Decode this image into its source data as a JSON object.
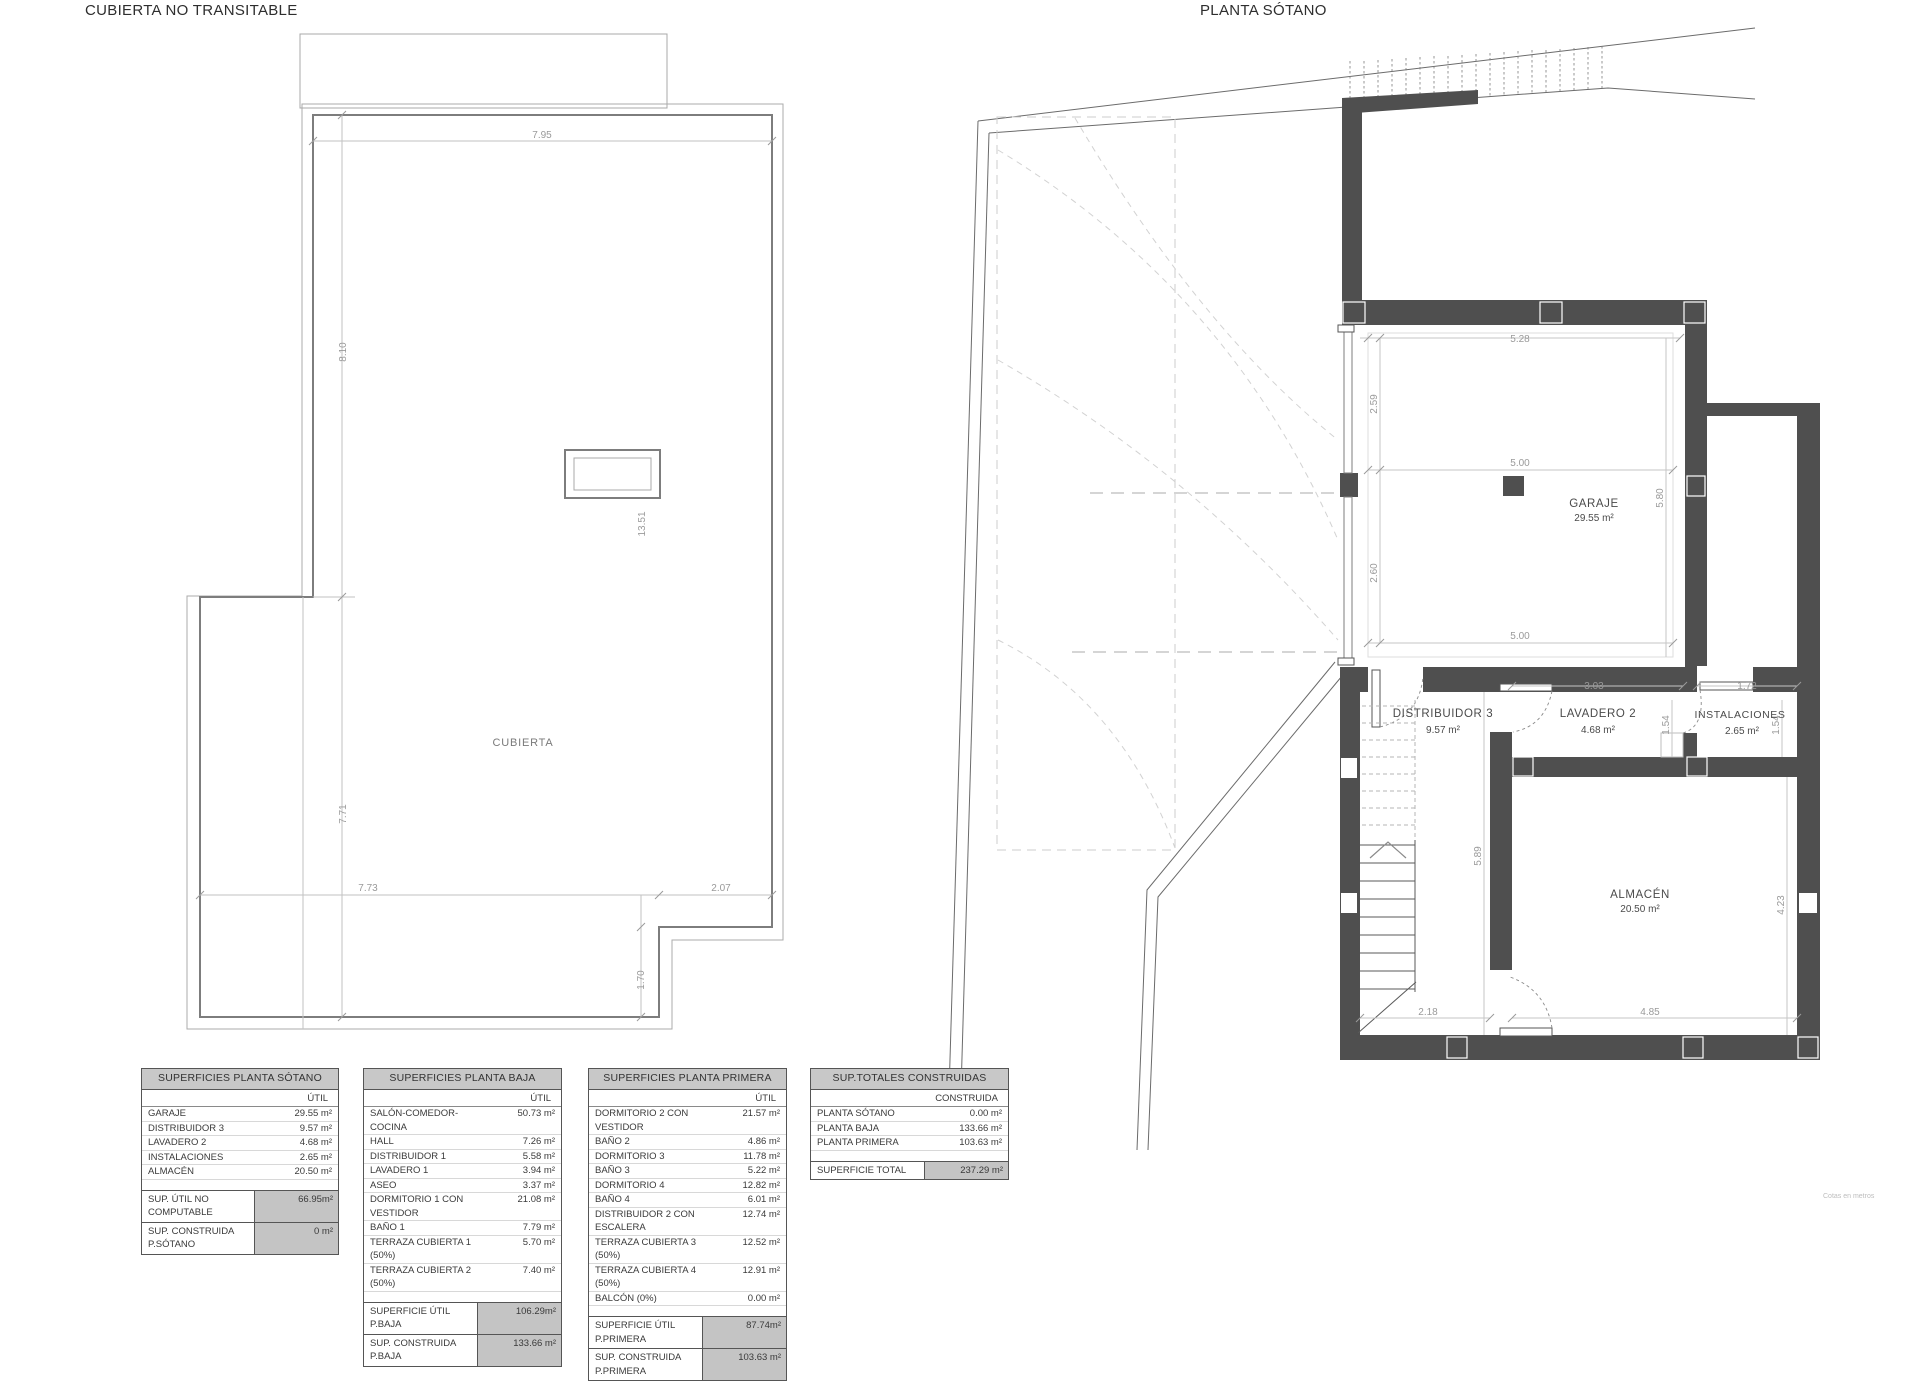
{
  "left_plan": {
    "title": "CUBIERTA NO TRANSITABLE",
    "room_label": "CUBIERTA",
    "dims": {
      "top": "7.95",
      "left_upper": "8.10",
      "left_lower": "7.71",
      "skylight": "13.51",
      "bottom_left": "7.73",
      "bottom_right": "2.07",
      "notch": "1.70"
    }
  },
  "right_plan": {
    "title": "PLANTA SÓTANO",
    "rooms": {
      "garaje": {
        "name": "GARAJE",
        "area": "29.55 m²"
      },
      "distribuidor": {
        "name": "DISTRIBUIDOR 3",
        "area": "9.57 m²"
      },
      "lavadero": {
        "name": "LAVADERO 2",
        "area": "4.68 m²"
      },
      "instalaciones": {
        "name": "INSTALACIONES",
        "area": "2.65 m²"
      },
      "almacen": {
        "name": "ALMACÉN",
        "area": "20.50 m²"
      }
    },
    "dims": {
      "d528": "5.28",
      "d259": "2.59",
      "d500a": "5.00",
      "d580": "5.80",
      "d260": "2.60",
      "d500b": "5.00",
      "d303": "3.03",
      "d172": "1.72",
      "d154a": "1.54",
      "d154b": "1.54",
      "d589": "5.89",
      "d218": "2.18",
      "d485": "4.85",
      "d423": "4.23"
    }
  },
  "tables": [
    {
      "title": "SUPERFICIES PLANTA SÓTANO",
      "col": "ÚTIL",
      "rows": [
        [
          "GARAJE",
          "29.55 m²"
        ],
        [
          "DISTRIBUIDOR 3",
          "9.57 m²"
        ],
        [
          "LAVADERO 2",
          "4.68 m²"
        ],
        [
          "INSTALACIONES",
          "2.65 m²"
        ],
        [
          "ALMACÉN",
          "20.50 m²"
        ]
      ],
      "summary": [
        [
          "SUP. ÚTIL NO COMPUTABLE",
          "66.95m²"
        ],
        [
          "SUP. CONSTRUIDA P.SÓTANO",
          "0 m²"
        ]
      ]
    },
    {
      "title": "SUPERFICIES PLANTA BAJA",
      "col": "ÚTIL",
      "rows": [
        [
          "SALÓN-COMEDOR-COCINA",
          "50.73 m²"
        ],
        [
          "HALL",
          "7.26 m²"
        ],
        [
          "DISTRIBUIDOR 1",
          "5.58 m²"
        ],
        [
          "LAVADERO 1",
          "3.94 m²"
        ],
        [
          "ASEO",
          "3.37 m²"
        ],
        [
          "DORMITORIO 1 CON VESTIDOR",
          "21.08 m²"
        ],
        [
          "BAÑO 1",
          "7.79 m²"
        ],
        [
          "TERRAZA CUBIERTA 1 (50%)",
          "5.70 m²"
        ],
        [
          "TERRAZA CUBIERTA 2 (50%)",
          "7.40 m²"
        ]
      ],
      "summary": [
        [
          "SUPERFICIE ÚTIL P.BAJA",
          "106.29m²"
        ],
        [
          "SUP. CONSTRUIDA P.BAJA",
          "133.66 m²"
        ]
      ]
    },
    {
      "title": "SUPERFICIES PLANTA PRIMERA",
      "col": "ÚTIL",
      "rows": [
        [
          "DORMITORIO 2 CON VESTIDOR",
          "21.57 m²"
        ],
        [
          "BAÑO 2",
          "4.86 m²"
        ],
        [
          "DORMITORIO 3",
          "11.78 m²"
        ],
        [
          "BAÑO 3",
          "5.22 m²"
        ],
        [
          "DORMITORIO 4",
          "12.82 m²"
        ],
        [
          "BAÑO 4",
          "6.01 m²"
        ],
        [
          "DISTRIBUIDOR 2 CON ESCALERA",
          "12.74 m²"
        ],
        [
          "TERRAZA CUBIERTA 3 (50%)",
          "12.52 m²"
        ],
        [
          "TERRAZA CUBIERTA 4 (50%)",
          "12.91 m²"
        ],
        [
          "BALCÓN (0%)",
          "0.00 m²"
        ]
      ],
      "summary": [
        [
          "SUPERFICIE ÚTIL P.PRIMERA",
          "87.74m²"
        ],
        [
          "SUP. CONSTRUIDA P.PRIMERA",
          "103.63 m²"
        ]
      ]
    },
    {
      "title": "SUP.TOTALES CONSTRUIDAS",
      "col": "CONSTRUIDA",
      "rows": [
        [
          "PLANTA SÓTANO",
          "0.00 m²"
        ],
        [
          "PLANTA BAJA",
          "133.66 m²"
        ],
        [
          "PLANTA PRIMERA",
          "103.63 m²"
        ]
      ],
      "summary": [
        [
          "SUPERFICIE TOTAL",
          "237.29 m²"
        ]
      ]
    }
  ],
  "footnote": "Cotas en metros"
}
